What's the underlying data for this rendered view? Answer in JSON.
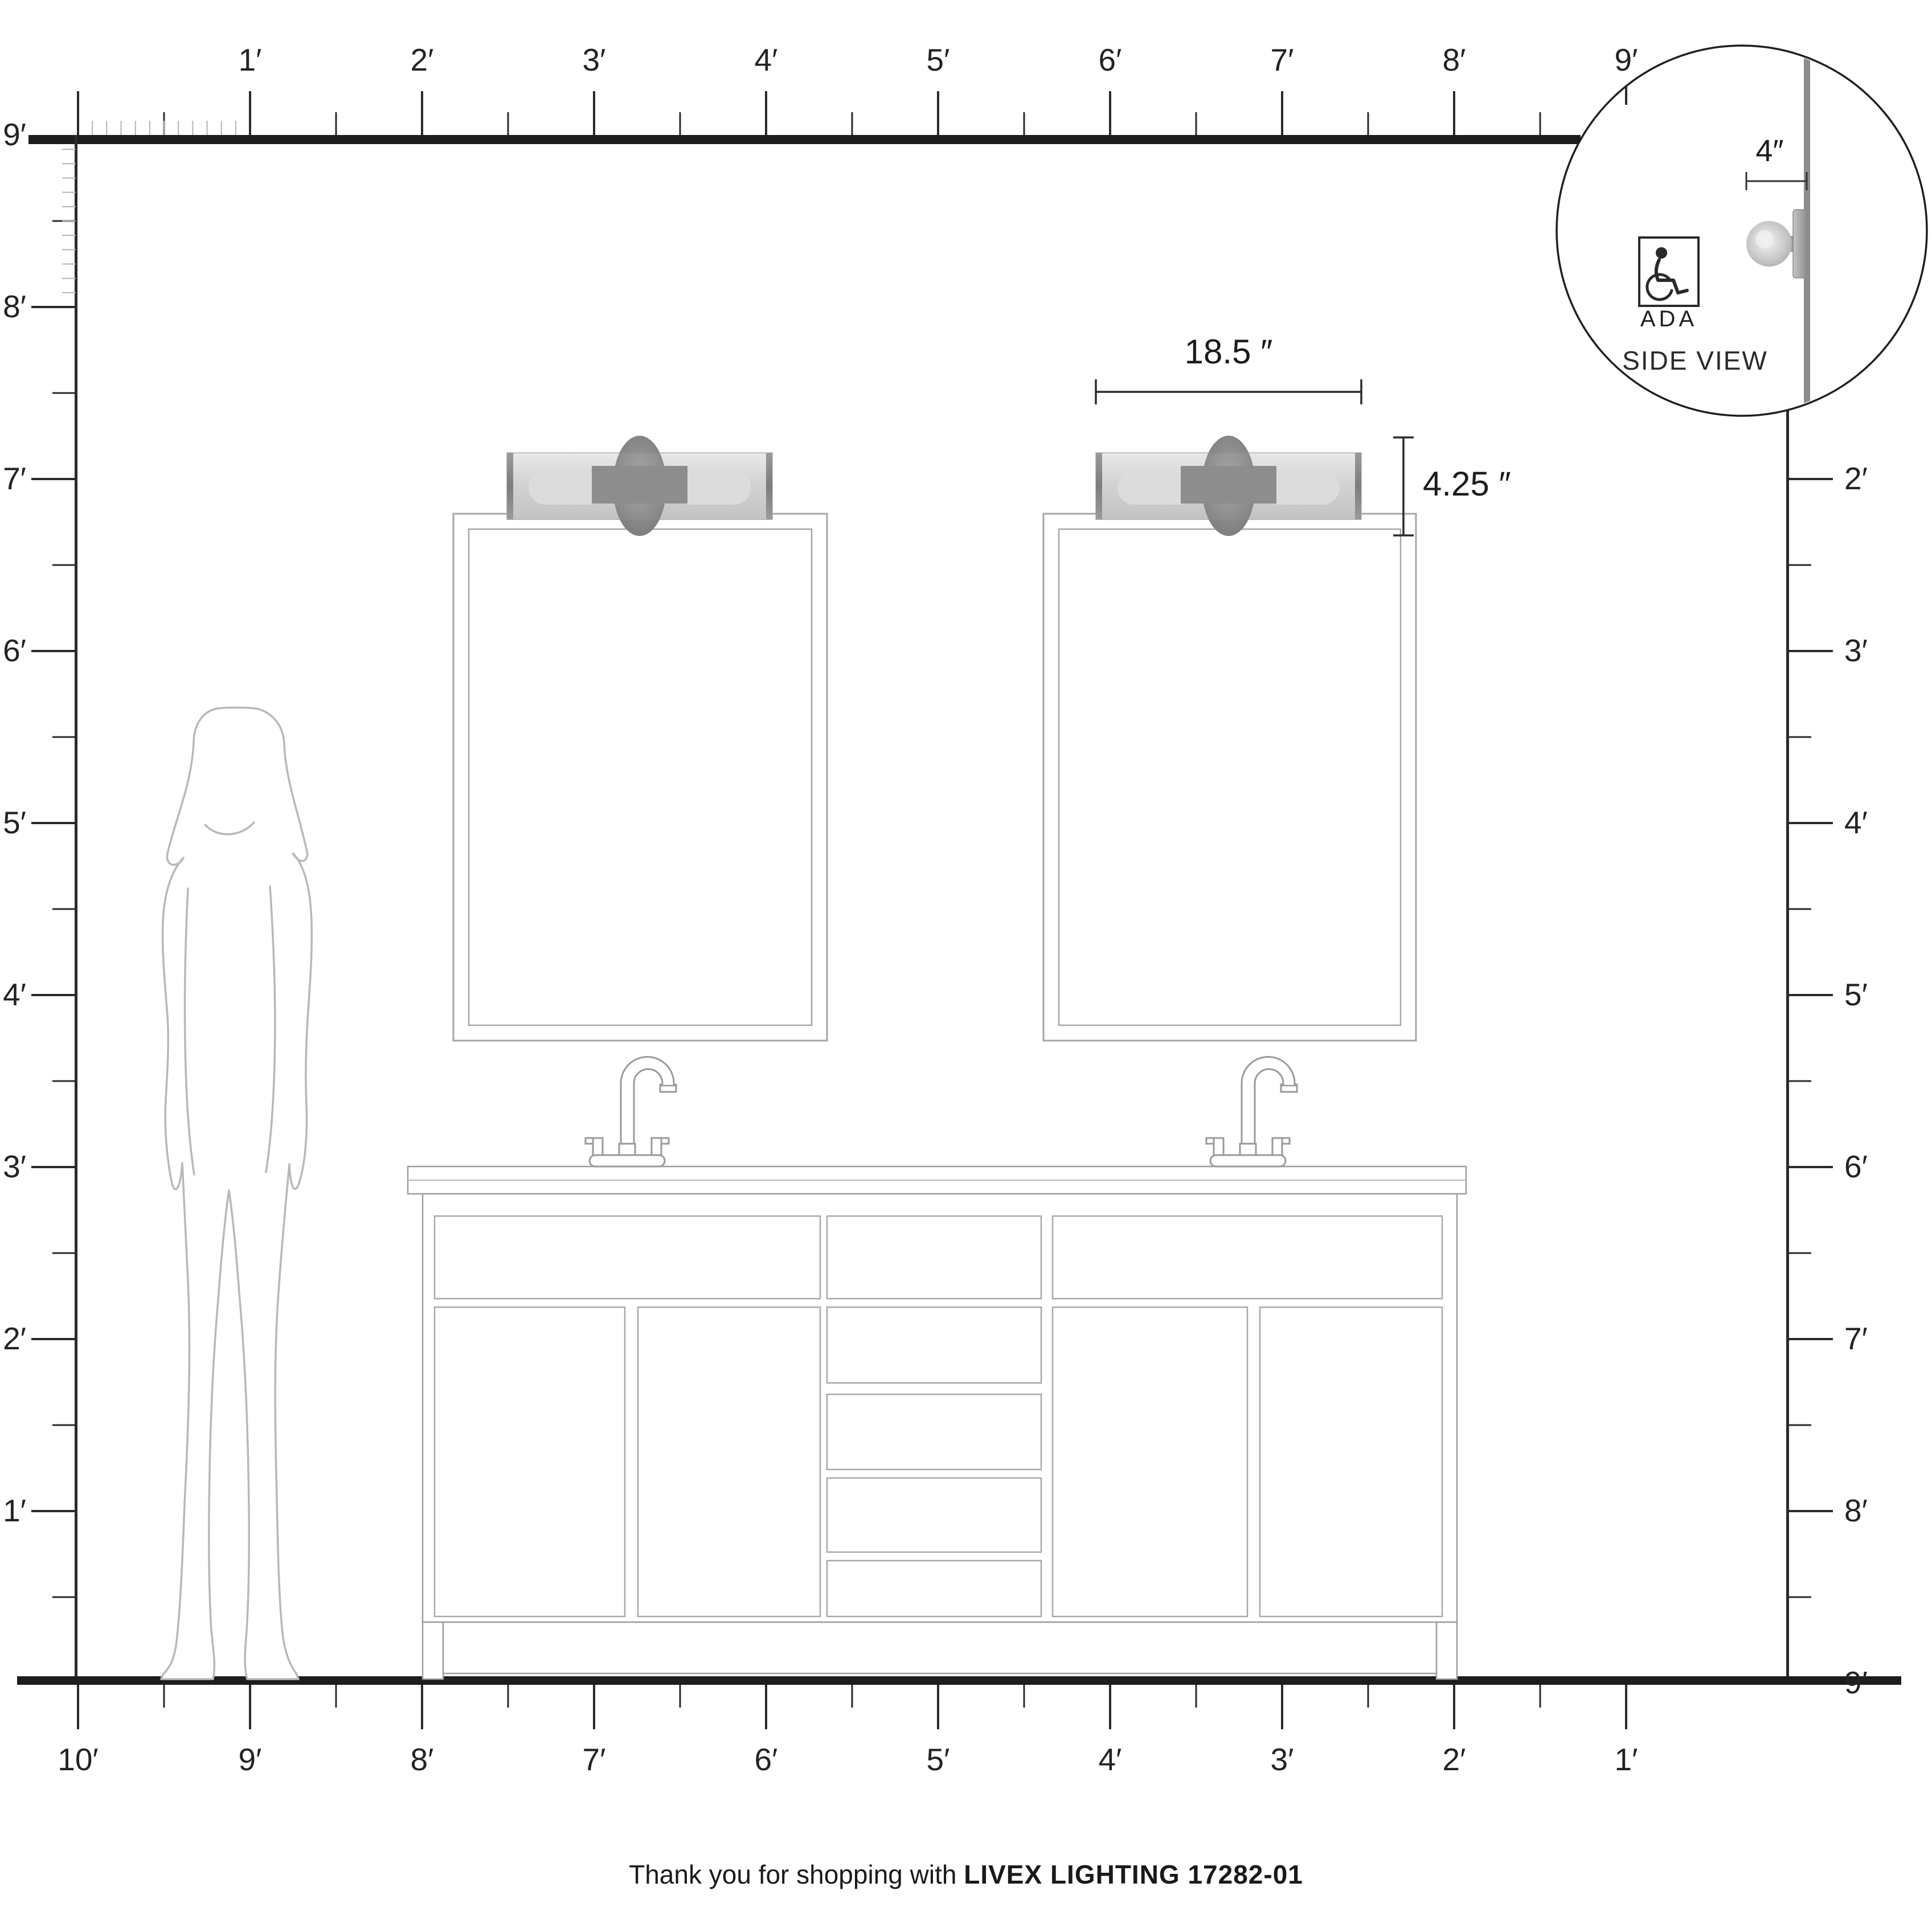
{
  "rulers": {
    "top": [
      "1′",
      "2′",
      "3′",
      "4′",
      "5′",
      "6′",
      "7′",
      "8′",
      "9′"
    ],
    "left": [
      "9′",
      "8′",
      "7′",
      "6′",
      "5′",
      "4′",
      "3′",
      "2′",
      "1′"
    ],
    "right": [
      "2′",
      "3′",
      "4′",
      "5′",
      "6′",
      "7′",
      "8′",
      "9′"
    ],
    "bottom": [
      "10′",
      "9′",
      "8′",
      "7′",
      "6′",
      "5′",
      "4′",
      "3′",
      "2′",
      "1′"
    ]
  },
  "dimensions": {
    "fixture_width": "18.5 ″",
    "fixture_height": "4.25 ″",
    "wall_offset": "4″"
  },
  "inset": {
    "ada_label": "ADA",
    "side_view_label": "SIDE VIEW"
  },
  "icons": {
    "ada_symbol": "wheelchair-icon"
  },
  "footer": {
    "prefix": "Thank you for shopping with",
    "brand": "LIVEX LIGHTING 17282-01"
  },
  "colors": {
    "ink": "#1f1f1f",
    "ruler_inch_gray": "#b4b4b4",
    "outline_gray": "#9a9a9a",
    "silhouette_gray": "#b8b8b8",
    "wall_gray": "#8c8c8c",
    "fixture_gray": "#c9c9c9"
  }
}
